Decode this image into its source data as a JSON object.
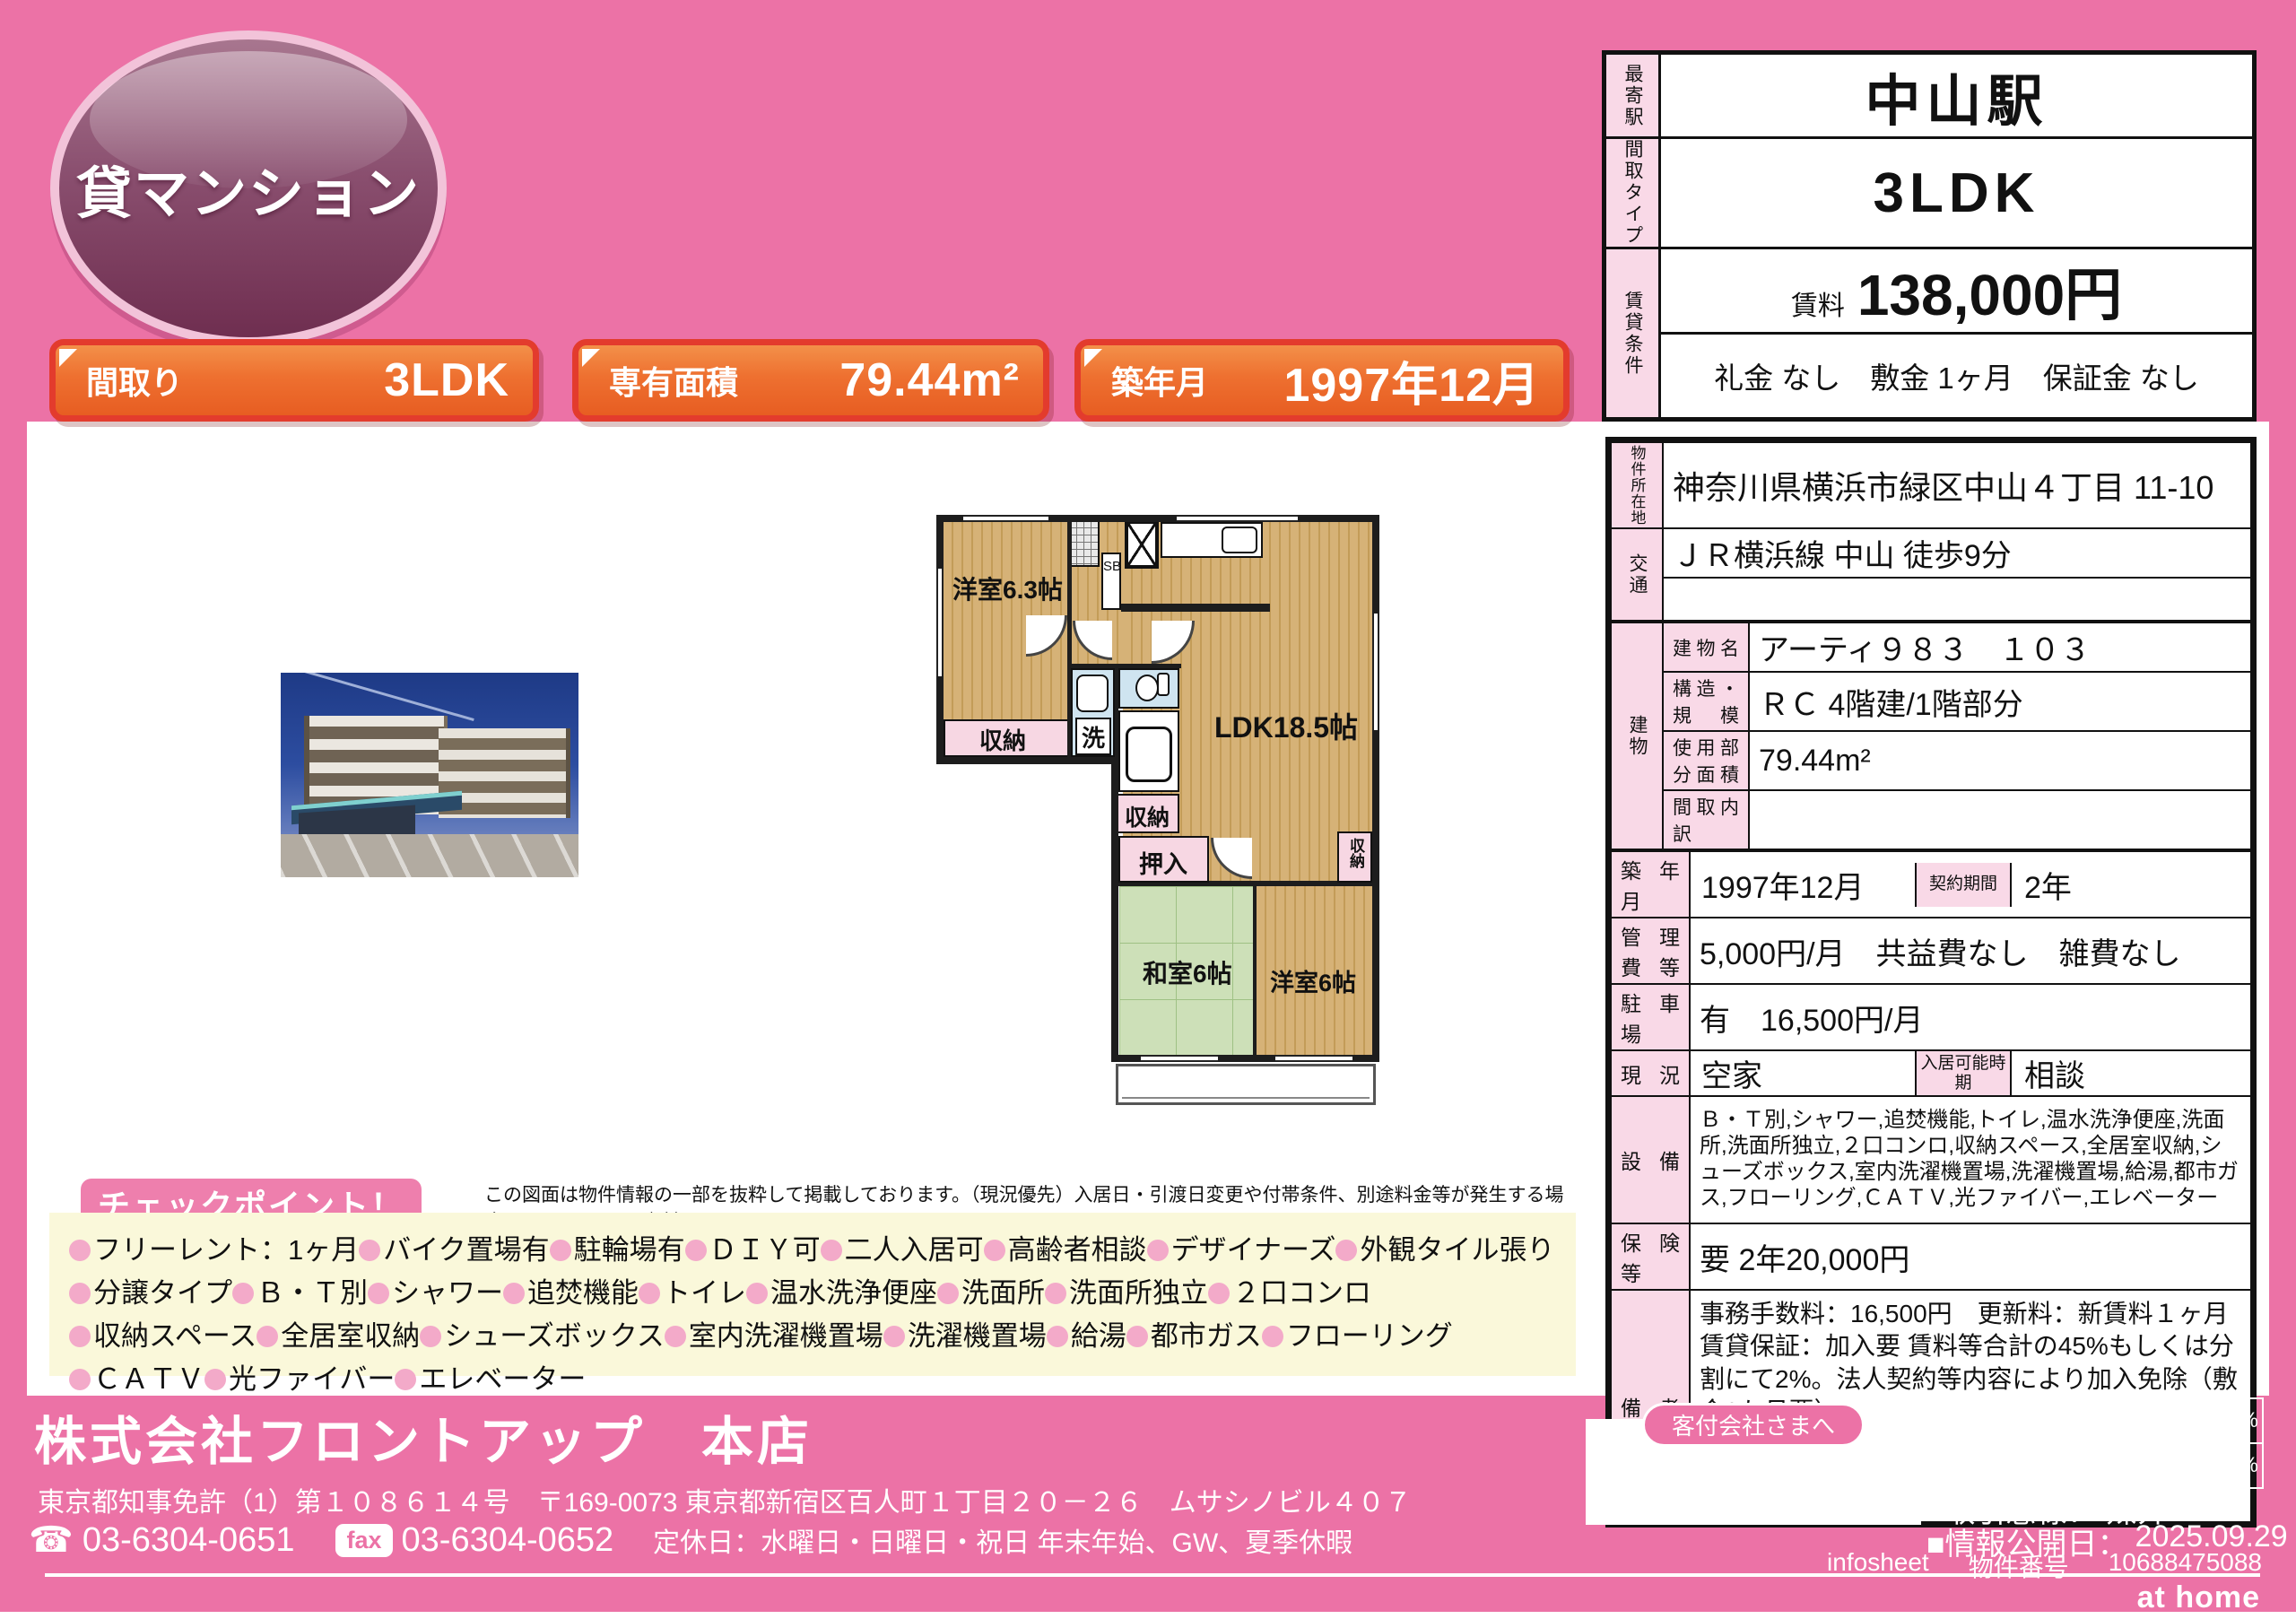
{
  "colors": {
    "bg_pink": "#ec72a6",
    "label_pink": "#f9d9e7",
    "accent_orange": "#ee7030",
    "accent_red": "#e33b2d",
    "badge_plum": "#6f2e50",
    "yellow_box": "#faf8da",
    "wood": "#d6b277",
    "tatami": "#cde0b8",
    "wet_blue": "#cfe4f0"
  },
  "badge": {
    "label": "貸マンション"
  },
  "info_bars": [
    {
      "label": "間取り",
      "value": "3LDK"
    },
    {
      "label": "専有面積",
      "value": "79.44m²"
    },
    {
      "label": "築年月",
      "value": "1997年12月"
    }
  ],
  "summary": {
    "station_label": "最寄駅",
    "station": "中山駅",
    "type_label": "間取タイプ",
    "type": "3LDK",
    "cond_label": "賃貸条件",
    "rent_label": "賃料",
    "rent": "138,000円",
    "conditions": "礼金 なし　敷金 1ヶ月　保証金 なし"
  },
  "detail": {
    "location_label": "物件所在地",
    "location": "神奈川県横浜市緑区中山４丁目 11-10",
    "access_label": "交通",
    "access1": "ＪＲ横浜線 中山 徒歩9分",
    "access2": "",
    "building_label": "建物",
    "building_rows": [
      {
        "label": "建物名",
        "value": "アーティ９８３　１０３"
      },
      {
        "label": "構造・規模",
        "value": "ＲＣ 4階建/1階部分"
      },
      {
        "label": "使用部分面積",
        "value": "79.44m²"
      },
      {
        "label": "間取内訳",
        "value": ""
      }
    ],
    "built_label": "築年月",
    "built": "1997年12月",
    "term_label": "契約期間",
    "term": "2年",
    "fees_label": "管理費等",
    "fees": "5,000円/月　共益費なし　雑費なし",
    "parking_label": "駐車場",
    "parking": "有　16,500円/月",
    "status_label": "現況",
    "status": "空家",
    "movein_label": "入居可能時期",
    "movein": "相談",
    "equipment_label": "設備",
    "equipment": "Ｂ・Ｔ別,シャワー,追焚機能,トイレ,温水洗浄便座,洗面所,洗面所独立,２口コンロ,収納スペース,全居室収納,シューズボックス,室内洗濯機置場,洗濯機置場,給湯,都市ガス,フローリング,ＣＡＴＶ,光ファイバー,エレベーター",
    "insurance_label": "保険等",
    "insurance": "要 2年20,000円",
    "notes_label": "備考",
    "notes": "事務手数料：16,500円　更新料：新賃料１ヶ月　賃貸保証：加入要 賃料等合計の45%もしくは分割にて2%。法人契約等内容により加入免除（敷金2か月要）"
  },
  "floorplan": {
    "room1": "洋室6.3帖",
    "closet1": "収納",
    "sb": "SB",
    "ldk": "LDK18.5帖",
    "laundry": "洗",
    "closet2": "収納",
    "oshiire": "押入",
    "washitsu": "和室6帖",
    "room2": "洋室6帖",
    "closet3": "収納"
  },
  "disclaimer": "この図面は物件情報の一部を抜粋して掲載しております。（現況優先）入居日・引渡日変更や付帯条件、別途料金等が発生する場合もありますのでご確認ください。",
  "checkpoint": {
    "title": "チェックポイント！",
    "items": [
      "フリーレント：1ヶ月",
      "バイク置場有",
      "駐輪場有",
      "ＤＩＹ可",
      "二人入居可",
      "高齢者相談",
      "デザイナーズ",
      "外観タイル張り",
      "分譲タイプ",
      "Ｂ・Ｔ別",
      "シャワー",
      "追焚機能",
      "トイレ",
      "温水洗浄便座",
      "洗面所",
      "洗面所独立",
      "２口コンロ",
      "収納スペース",
      "全居室収納",
      "シューズボックス",
      "室内洗濯機置場",
      "洗濯機置場",
      "給湯",
      "都市ガス",
      "フローリング",
      "ＣＡＴＶ",
      "光ファイバー",
      "エレベーター"
    ]
  },
  "footer": {
    "company": "株式会社フロントアップ　本店",
    "license": "東京都知事免許（1）第１０８６１４号　〒169-0073 東京都新宿区百人町１丁目２０－２６　ムサシノビル４０７",
    "tel_icon": "☎",
    "tel": "03-6304-0651",
    "fax_label": "fax",
    "fax": "03-6304-0652",
    "holidays": "定休日：水曜日・日曜日・祝日 年末年始、GW、夏季休暇",
    "agent_box_label": "客付会社さまへ",
    "fee_block_label": "手数料",
    "fee_rows": [
      {
        "label": "客付手数料負担の割合",
        "t1": "貸主",
        "v1": "0%",
        "t2": "借主",
        "v2": "100%"
      },
      {
        "label": "客付手数料配分の割合",
        "t1": "元付",
        "v1": "0%",
        "t2": "客付",
        "v2": "100%"
      }
    ],
    "deal_label": "■取引態様：",
    "deal": "媒介",
    "publish_label": "■情報公開日：",
    "publish": "2025.09.29",
    "infosheet": "infosheet",
    "bukken_label": "物件番号",
    "bukken_no": "10688475088",
    "logo": "at home"
  }
}
